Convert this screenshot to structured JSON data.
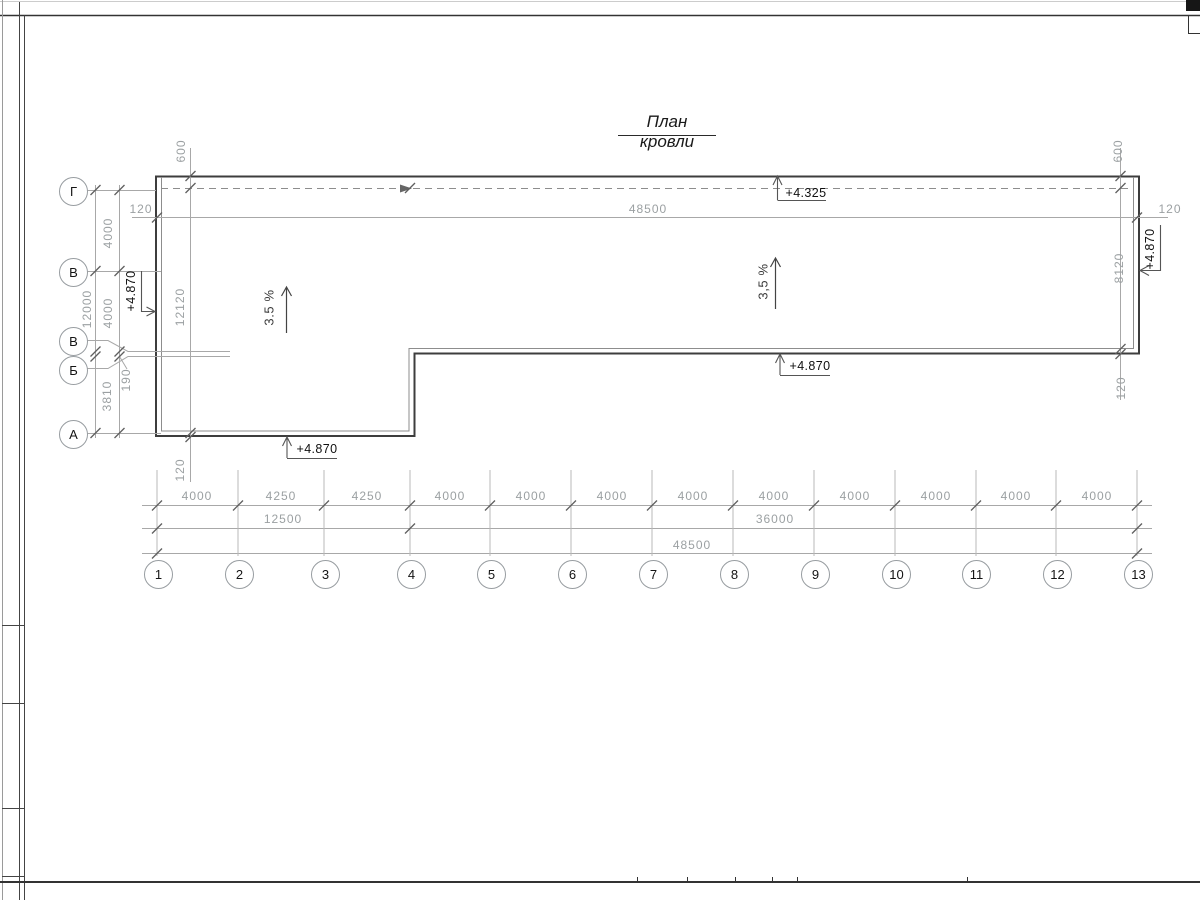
{
  "title": "План кровли",
  "row_axes": {
    "labels": [
      "Г",
      "В",
      "В",
      "Б",
      "А"
    ]
  },
  "col_axes": {
    "labels": [
      "1",
      "2",
      "3",
      "4",
      "5",
      "6",
      "7",
      "8",
      "9",
      "10",
      "11",
      "12",
      "13"
    ]
  },
  "elevations": {
    "top": "+4.325",
    "step": "+4.870",
    "bottom_left": "+4.870",
    "left_edge": "+4.870",
    "right_edge": "+4.870"
  },
  "slopes": {
    "left": "3.5 %",
    "right": "3,5 %"
  },
  "dim": {
    "top_left_offset": "120",
    "top_total": "48500",
    "top_right_offset": "120",
    "left_overall": "12000",
    "left_seg_1": "4000",
    "left_seg_2": "4000",
    "left_seg_3": "190",
    "left_seg_4": "3810",
    "left_parapet_top": "600",
    "left_inner_total": "12120",
    "left_parapet_bottom": "120",
    "right_parapet_top": "600",
    "right_inner": "8120",
    "right_parapet_bottom": "120",
    "bottom_segments": [
      "4000",
      "4250",
      "4250",
      "4000",
      "4000",
      "4000",
      "4000",
      "4000",
      "4000",
      "4000",
      "4000",
      "4000"
    ],
    "bottom_group_left": "12500",
    "bottom_group_right": "36000",
    "bottom_total": "48500"
  }
}
